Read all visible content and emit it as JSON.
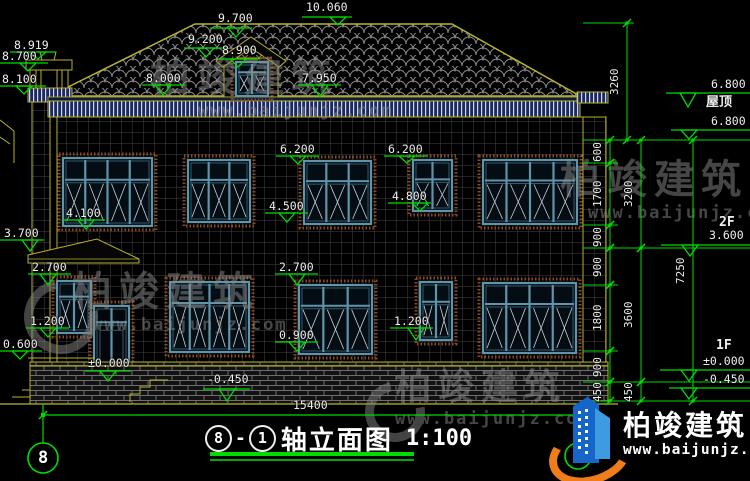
{
  "title": {
    "axis_from": "8",
    "separator": "-",
    "axis_to": "1",
    "name": "轴立面图",
    "scale": "1:100"
  },
  "watermark": {
    "brand": "柏竣建筑",
    "url": "www.baijunjz.com"
  },
  "logo": {
    "brand": "柏竣建筑",
    "url": "www.baijunjz.com"
  },
  "colors": {
    "background": "#000000",
    "outline_yellow": "#b9b22e",
    "dim_green": "#00dc00",
    "text_white": "#efefef",
    "frame_teal": "#5f95aa",
    "frame_dark": "#335c6d",
    "glass": "#040d14",
    "surround_rust": "#8a4a1e",
    "eave_navy": "#1c2a5c",
    "grid_gray": "#454545",
    "roof_gray": "#8f8f8f",
    "logo_blue": "#1467c8",
    "logo_orange": "#ef7d1a",
    "watermark_gray": "#8c8c8c"
  },
  "levels": [
    {
      "t": "10.060",
      "tx": 306,
      "ty": 2,
      "l": [
        302,
        352,
        17
      ],
      "a": [
        338,
        25
      ]
    },
    {
      "t": "9.700",
      "tx": 218,
      "ty": 13,
      "l": [
        210,
        252,
        28
      ],
      "a": [
        236,
        37
      ]
    },
    {
      "t": "9.200",
      "tx": 188,
      "ty": 34,
      "l": [
        184,
        226,
        48
      ],
      "a": [
        206,
        57
      ]
    },
    {
      "t": "8.900",
      "tx": 222,
      "ty": 45,
      "l": [
        218,
        260,
        59
      ],
      "a": [
        238,
        67
      ]
    },
    {
      "t": "8.919",
      "tx": 14,
      "ty": 40,
      "l": [
        10,
        56,
        52
      ],
      "a": [
        38,
        59
      ]
    },
    {
      "t": "8.700",
      "tx": 2,
      "ty": 51,
      "l": [
        0,
        48,
        63
      ],
      "a": [
        28,
        71
      ]
    },
    {
      "t": "8.100",
      "tx": 2,
      "ty": 74,
      "l": [
        0,
        46,
        86
      ],
      "a": [
        24,
        94
      ]
    },
    {
      "t": "8.000",
      "tx": 146,
      "ty": 73,
      "l": [
        142,
        185,
        85
      ],
      "a": [
        163,
        95
      ]
    },
    {
      "t": "7.950",
      "tx": 302,
      "ty": 73,
      "l": [
        298,
        341,
        85
      ],
      "a": [
        320,
        97
      ]
    },
    {
      "t": "6.200",
      "tx": 280,
      "ty": 144,
      "l": [
        276,
        319,
        156
      ],
      "a": [
        298,
        164
      ]
    },
    {
      "t": "6.200",
      "tx": 388,
      "ty": 144,
      "l": [
        384,
        427,
        156
      ],
      "a": [
        407,
        163
      ]
    },
    {
      "t": "4.500",
      "tx": 269,
      "ty": 201,
      "l": [
        265,
        308,
        213
      ],
      "a": [
        287,
        222
      ]
    },
    {
      "t": "4.800",
      "tx": 392,
      "ty": 191,
      "l": [
        388,
        431,
        203
      ],
      "a": [
        420,
        211
      ]
    },
    {
      "t": "4.100",
      "tx": 66,
      "ty": 208,
      "l": [
        62,
        105,
        220
      ],
      "a": [
        86,
        229
      ]
    },
    {
      "t": "3.700",
      "tx": 4,
      "ty": 228,
      "l": [
        0,
        44,
        240
      ],
      "a": [
        30,
        251
      ]
    },
    {
      "t": "2.700",
      "tx": 32,
      "ty": 262,
      "l": [
        28,
        71,
        274
      ],
      "a": [
        48,
        285
      ]
    },
    {
      "t": "2.700",
      "tx": 279,
      "ty": 262,
      "l": [
        275,
        318,
        274
      ],
      "a": [
        297,
        285
      ]
    },
    {
      "t": "1.200",
      "tx": 30,
      "ty": 316,
      "l": [
        26,
        69,
        328
      ],
      "a": [
        48,
        337
      ]
    },
    {
      "t": "1.200",
      "tx": 394,
      "ty": 316,
      "l": [
        390,
        433,
        328
      ],
      "a": [
        416,
        340
      ]
    },
    {
      "t": "0.600",
      "tx": 3,
      "ty": 339,
      "l": [
        0,
        42,
        351
      ],
      "a": [
        20,
        359
      ]
    },
    {
      "t": "0.900",
      "tx": 279,
      "ty": 330,
      "l": [
        275,
        318,
        342
      ],
      "a": [
        297,
        351
      ]
    },
    {
      "t": "±0.000",
      "tx": 88,
      "ty": 358,
      "l": [
        85,
        131,
        371
      ],
      "a": [
        108,
        381
      ]
    },
    {
      "t": "-0.450",
      "tx": 207,
      "ty": 374,
      "l": [
        203,
        250,
        389
      ],
      "a": [
        227,
        401
      ]
    },
    {
      "t": "6.800",
      "tx": 711,
      "ty": 79,
      "l": [
        666,
        750,
        93
      ],
      "a": [
        688,
        107
      ]
    },
    {
      "t": "6.800",
      "tx": 711,
      "ty": 116,
      "l": [
        671,
        750,
        130
      ],
      "a": [
        689,
        139
      ]
    },
    {
      "t": "3.600",
      "tx": 709,
      "ty": 230,
      "l": [
        661,
        750,
        245
      ],
      "a": [
        690,
        256
      ]
    },
    {
      "t": "±0.000",
      "tx": 703,
      "ty": 356,
      "l": [
        660,
        750,
        370
      ],
      "a": [
        689,
        381
      ]
    },
    {
      "t": "-0.450",
      "tx": 703,
      "ty": 374,
      "l": [
        669,
        750,
        388
      ],
      "a": [
        689,
        399
      ]
    }
  ],
  "side_texts": [
    {
      "t": "屋顶",
      "x": 706,
      "y": 96
    },
    {
      "t": "2F",
      "x": 719,
      "y": 216
    },
    {
      "t": "1F",
      "x": 716,
      "y": 339
    }
  ],
  "chains": [
    {
      "x": 610,
      "segments": [
        {
          "v": "600",
          "y1": 140,
          "y2": 163
        },
        {
          "v": "1700",
          "y1": 163,
          "y2": 225
        },
        {
          "v": "900",
          "y1": 225,
          "y2": 248
        },
        {
          "v": "900",
          "y1": 248,
          "y2": 285
        },
        {
          "v": "1800",
          "y1": 285,
          "y2": 351
        },
        {
          "v": "900",
          "y1": 351,
          "y2": 382
        },
        {
          "v": "450",
          "y1": 382,
          "y2": 401
        }
      ]
    },
    {
      "x": 641,
      "segments": [
        {
          "v": "3200",
          "y1": 140,
          "y2": 248
        },
        {
          "v": "3600",
          "y1": 248,
          "y2": 382
        },
        {
          "v": "450",
          "y1": 382,
          "y2": 401
        }
      ]
    },
    {
      "x": 627,
      "segments": [
        {
          "v": "3260",
          "y1": 23,
          "y2": 140
        }
      ]
    },
    {
      "x": 693,
      "segments": [
        {
          "v": "7250",
          "y1": 140,
          "y2": 401
        }
      ]
    }
  ],
  "hlines": [
    [
      583,
      750,
      140
    ],
    [
      583,
      750,
      248
    ],
    [
      583,
      750,
      382
    ],
    [
      583,
      750,
      401
    ],
    [
      583,
      618,
      163
    ],
    [
      583,
      618,
      225
    ],
    [
      583,
      618,
      285
    ],
    [
      583,
      618,
      351
    ],
    [
      583,
      634,
      23
    ]
  ],
  "overall_dim": {
    "text": "15400",
    "x1": 43,
    "x2": 578,
    "y": 415,
    "tx": 293,
    "ty": 400
  },
  "axes": [
    {
      "label": "8",
      "cx": 43,
      "cy": 458,
      "r": 15,
      "line_top": 404
    },
    {
      "label": "1",
      "cx": 578,
      "cy": 456,
      "r": 13,
      "line_top": 404
    }
  ],
  "windows": [
    {
      "x": 63,
      "y": 158,
      "w": 89,
      "h": 68,
      "cols": 4,
      "transom": 0.32,
      "kind": "window"
    },
    {
      "x": 188,
      "y": 160,
      "w": 62,
      "h": 62,
      "cols": 3,
      "transom": 0.32,
      "kind": "window"
    },
    {
      "x": 304,
      "y": 161,
      "w": 67,
      "h": 63,
      "cols": 3,
      "transom": 0.32,
      "kind": "window"
    },
    {
      "x": 413,
      "y": 160,
      "w": 39,
      "h": 51,
      "cols": 2,
      "transom": 0.38,
      "kind": "window"
    },
    {
      "x": 483,
      "y": 160,
      "w": 94,
      "h": 64,
      "cols": 4,
      "transom": 0.32,
      "kind": "window"
    },
    {
      "x": 57,
      "y": 281,
      "w": 34,
      "h": 52,
      "cols": 2,
      "transom": 0.3,
      "kind": "window"
    },
    {
      "x": 94,
      "y": 306,
      "w": 35,
      "h": 74,
      "cols": 2,
      "transom": 0.22,
      "kind": "door"
    },
    {
      "x": 170,
      "y": 282,
      "w": 79,
      "h": 70,
      "cols": 4,
      "transom": 0.3,
      "kind": "window"
    },
    {
      "x": 299,
      "y": 285,
      "w": 73,
      "h": 69,
      "cols": 3,
      "transom": 0.3,
      "kind": "window"
    },
    {
      "x": 420,
      "y": 282,
      "w": 32,
      "h": 58,
      "cols": 2,
      "transom": 0.34,
      "kind": "window"
    },
    {
      "x": 483,
      "y": 283,
      "w": 93,
      "h": 70,
      "cols": 4,
      "transom": 0.3,
      "kind": "window"
    },
    {
      "x": 236,
      "y": 62,
      "w": 32,
      "h": 34,
      "cols": 2,
      "transom": 0.3,
      "kind": "window"
    }
  ]
}
